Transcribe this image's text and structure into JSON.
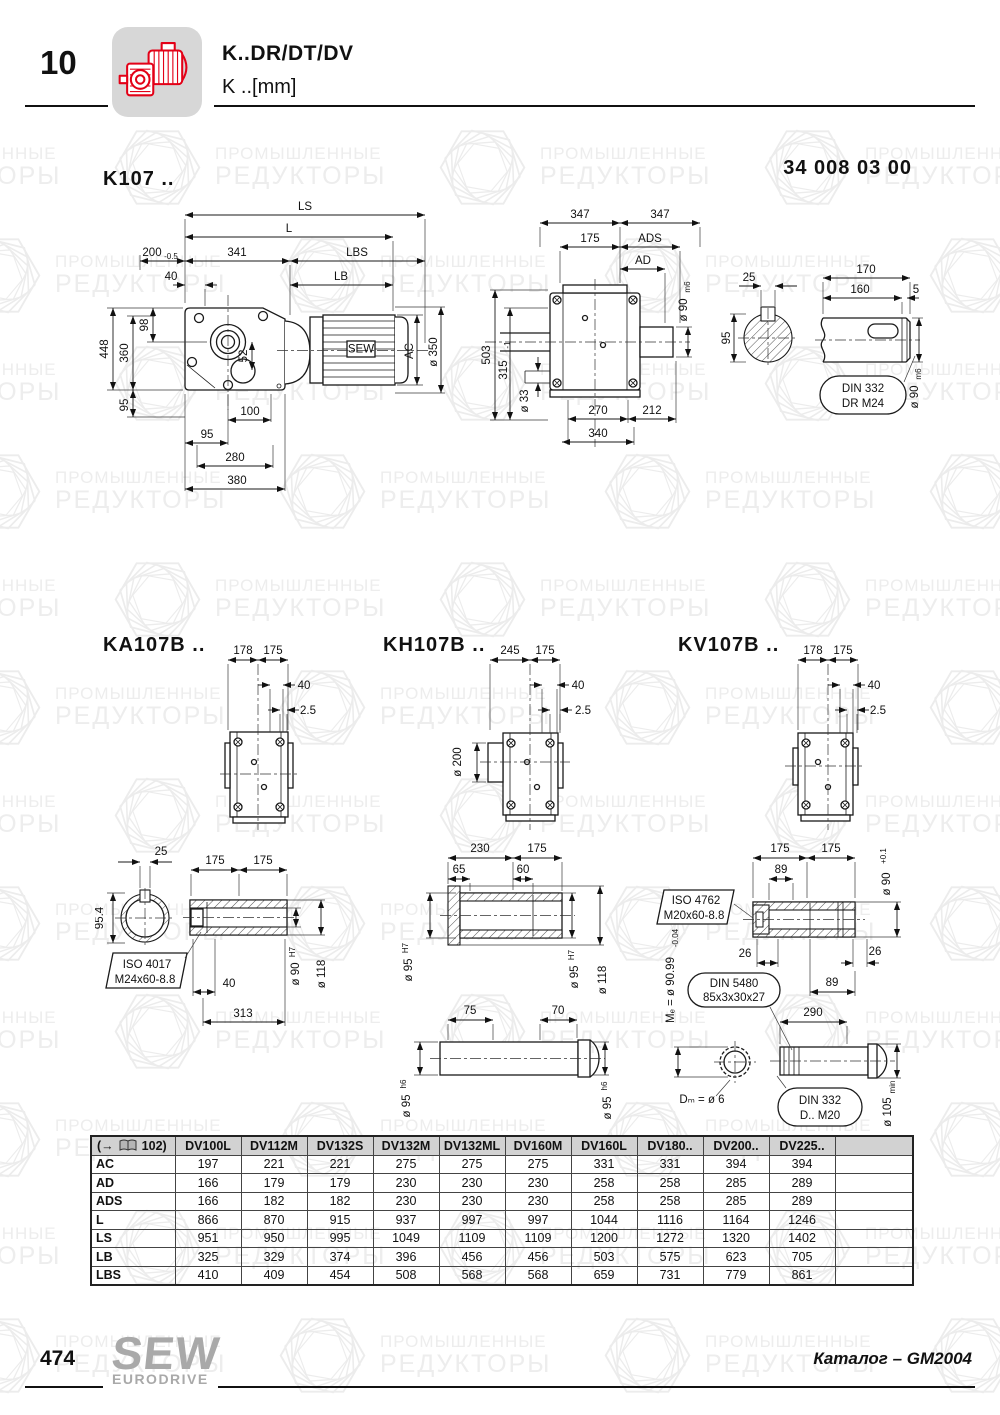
{
  "header": {
    "chapter": "10",
    "title": "K..DR/DT/DV",
    "subtitle": "K ..[mm]",
    "doc_number": "34 008 03 00"
  },
  "watermark": {
    "line1": "ПРОМЫШЛЕННЫЕ",
    "line2": "РЕДУКТОРЫ"
  },
  "k107": {
    "title": "K107 ..",
    "side": {
      "ls": "LS",
      "l": "L",
      "d200": "200",
      "d200_tol": "-0.5",
      "d341": "341",
      "lbs": "LBS",
      "d40": "40",
      "lb": "LB",
      "d448": "448",
      "d360": "360",
      "d98": "98",
      "d95_left": "95",
      "d52": "52",
      "ac": "AC",
      "d350": "ø 350",
      "d100": "100",
      "d95_bot": "95",
      "d280": "280",
      "d380": "380",
      "motor_logo": "SEW"
    },
    "front": {
      "d347_l": "347",
      "d347_r": "347",
      "d175": "175",
      "ads": "ADS",
      "ad": "AD",
      "d90": "ø 90",
      "d90_tol": "m6",
      "d503": "503",
      "d315": "315",
      "d315_tol": "-1",
      "d33": "ø 33",
      "d270": "270",
      "d212": "212",
      "d340": "340"
    },
    "shaft": {
      "d25": "25",
      "d95": "95",
      "d170": "170",
      "d160": "160",
      "d5": "5",
      "d90": "ø 90",
      "d90_tol": "m6",
      "note1": "DIN 332",
      "note2": "DR M24"
    }
  },
  "ka107b": {
    "title": "KA107B ..",
    "flange": {
      "d178": "178",
      "d175": "175",
      "d40": "40",
      "d25": "2.5"
    },
    "detail": {
      "d25": "25",
      "d954": "95.4",
      "d175_l": "175",
      "d175_r": "175",
      "note1": "ISO 4017",
      "note2": "M24x60-8.8",
      "d40": "40",
      "d313": "313",
      "d90": "ø 90",
      "d90_tol": "H7",
      "d118": "ø 118"
    }
  },
  "kh107b": {
    "title": "KH107B ..",
    "flange": {
      "d245": "245",
      "d175": "175",
      "d40": "40",
      "d25": "2.5",
      "d200": "ø 200"
    },
    "detail": {
      "d230": "230",
      "d175": "175",
      "d65": "65",
      "d60": "60",
      "d95_l": "ø 95",
      "d95_l_tol": "H7",
      "d95_r": "ø 95",
      "d95_r_tol": "H7",
      "d118": "ø 118",
      "d75": "75",
      "d70": "70",
      "d95_bl": "ø 95",
      "d95_bl_tol": "h6",
      "d95_br": "ø 95",
      "d95_br_tol": "h6"
    }
  },
  "kv107b": {
    "title": "KV107B ..",
    "flange": {
      "d178": "178",
      "d175": "175",
      "d40": "40",
      "d25": "2.5"
    },
    "detail": {
      "d175_l": "175",
      "d175_r": "175",
      "d89_top": "89",
      "d90": "ø 90",
      "d90_tol": "+0.1",
      "note1": "ISO 4762",
      "note2": "M20x60-8.8",
      "d26_l": "26",
      "d26_r": "26",
      "d89_r": "89",
      "me": "Mₑ = ø 90.99",
      "me_tol": "-0.04",
      "note3": "DIN 5480",
      "note4": "85x3x30x27",
      "d290": "290",
      "dm": "Dₘ = ø 6",
      "note5": "DIN 332",
      "note6": "D.. M20",
      "d105": "ø 105",
      "d105_tol": "min"
    }
  },
  "table": {
    "ref_open": "(→",
    "ref_num": "102)",
    "columns": [
      "DV100L",
      "DV112M",
      "DV132S",
      "DV132M",
      "DV132ML",
      "DV160M",
      "DV160L",
      "DV180..",
      "DV200..",
      "DV225.."
    ],
    "rows": [
      {
        "label": "AC",
        "values": [
          "197",
          "221",
          "221",
          "275",
          "275",
          "275",
          "331",
          "331",
          "394",
          "394"
        ]
      },
      {
        "label": "AD",
        "values": [
          "166",
          "179",
          "179",
          "230",
          "230",
          "230",
          "258",
          "258",
          "285",
          "289"
        ]
      },
      {
        "label": "ADS",
        "values": [
          "166",
          "182",
          "182",
          "230",
          "230",
          "230",
          "258",
          "258",
          "285",
          "289"
        ]
      },
      {
        "label": "L",
        "values": [
          "866",
          "870",
          "915",
          "937",
          "997",
          "997",
          "1044",
          "1116",
          "1164",
          "1246"
        ]
      },
      {
        "label": "LS",
        "values": [
          "951",
          "950",
          "995",
          "1049",
          "1109",
          "1109",
          "1200",
          "1272",
          "1320",
          "1402"
        ]
      },
      {
        "label": "LB",
        "values": [
          "325",
          "329",
          "374",
          "396",
          "456",
          "456",
          "503",
          "575",
          "623",
          "705"
        ]
      },
      {
        "label": "LBS",
        "values": [
          "410",
          "409",
          "454",
          "508",
          "568",
          "568",
          "659",
          "731",
          "779",
          "861"
        ]
      }
    ]
  },
  "footer": {
    "page": "474",
    "logo_top": "SEW",
    "logo_bottom": "EURODRIVE",
    "right": "Каталог – GM2004"
  }
}
